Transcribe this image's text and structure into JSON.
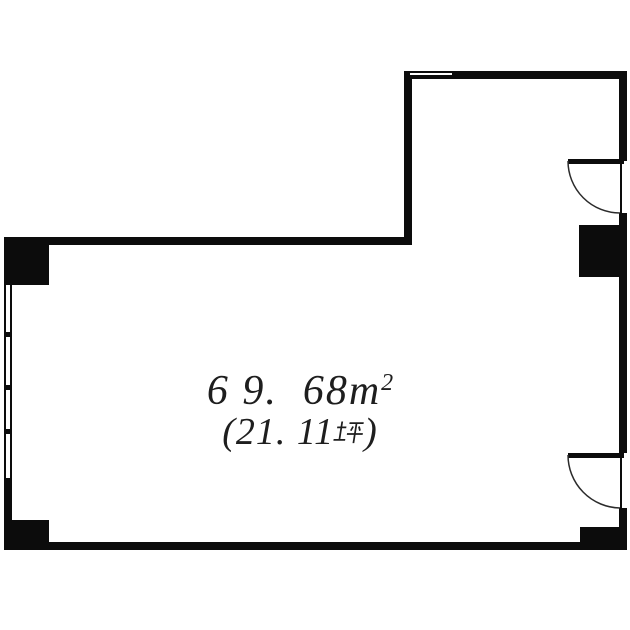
{
  "plan": {
    "area": {
      "m2_display": "6 9.  68m",
      "m2_sup": "2",
      "tsubo_open": "(21. 11",
      "tsubo_kanji": "坪",
      "tsubo_close": ")"
    },
    "colors": {
      "wall": "#0c0c0c",
      "text": "#1e1e1e",
      "background": "#ffffff",
      "arc": "#2b2b2b"
    }
  }
}
